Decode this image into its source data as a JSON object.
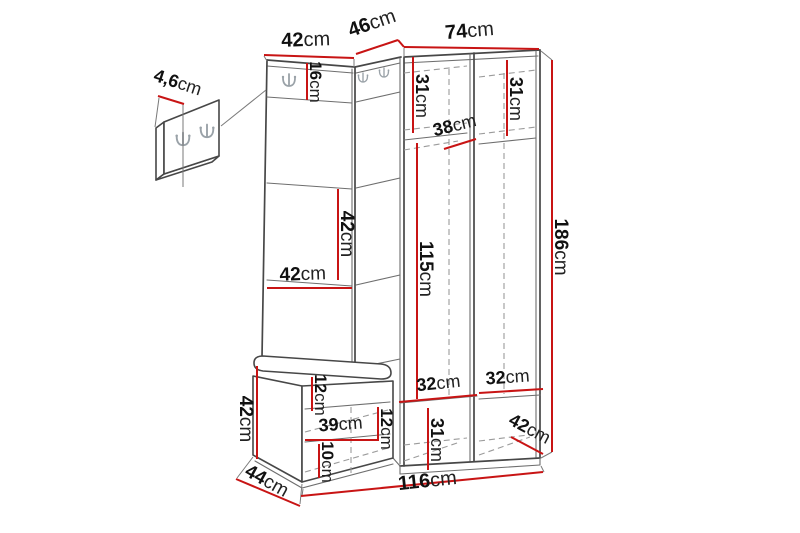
{
  "colors": {
    "dimension_line": "#c81414",
    "edge": "#474747",
    "hidden_edge": "#9b9b9b",
    "label": "#111111",
    "background": "#ffffff"
  },
  "icons": {
    "coat_hook": "double-coat-hook-icon"
  },
  "dimensions": {
    "top_left_width": {
      "value": "42",
      "unit": "cm"
    },
    "top_corner_width": {
      "value": "46",
      "unit": "cm"
    },
    "top_wardrobe_width": {
      "value": "74",
      "unit": "cm"
    },
    "hook_panel_height": {
      "value": "16",
      "unit": "cm"
    },
    "panel_thickness": {
      "value": "4,6",
      "unit": "cm"
    },
    "left_top_shelf_depth": {
      "value": "31",
      "unit": "cm"
    },
    "right_top_shelf_depth": {
      "value": "31",
      "unit": "cm"
    },
    "corner_shelf_width": {
      "value": "38",
      "unit": "cm"
    },
    "left_shelf_gap_height": {
      "value": "42",
      "unit": "cm"
    },
    "left_shelf_width": {
      "value": "42",
      "unit": "cm"
    },
    "hanging_space_height": {
      "value": "115",
      "unit": "cm"
    },
    "total_height": {
      "value": "186",
      "unit": "cm"
    },
    "bench_rail_height": {
      "value": "12",
      "unit": "cm"
    },
    "bench_height": {
      "value": "42",
      "unit": "cm"
    },
    "bench_opening_width": {
      "value": "39",
      "unit": "cm"
    },
    "bench_opening_height": {
      "value": "12",
      "unit": "cm"
    },
    "bench_shelf_gap": {
      "value": "10",
      "unit": "cm"
    },
    "bench_depth": {
      "value": "44",
      "unit": "cm"
    },
    "bottom_left_shelf_width": {
      "value": "32",
      "unit": "cm"
    },
    "bottom_right_shelf_width": {
      "value": "32",
      "unit": "cm"
    },
    "bottom_compartment_height": {
      "value": "31",
      "unit": "cm"
    },
    "cabinet_depth": {
      "value": "42",
      "unit": "cm"
    },
    "total_width": {
      "value": "116",
      "unit": "cm"
    }
  }
}
